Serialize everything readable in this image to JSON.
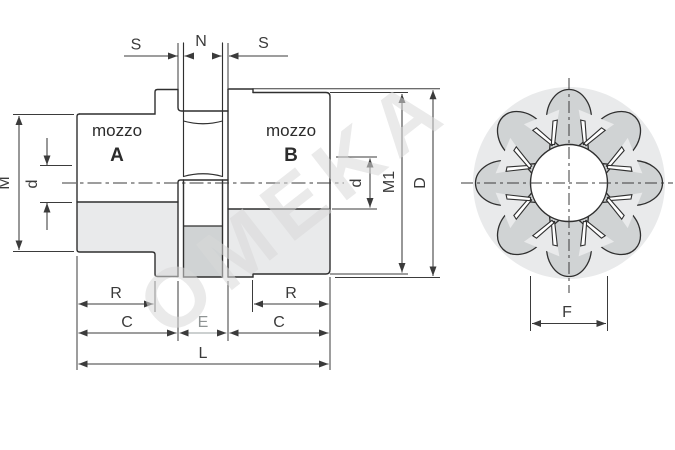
{
  "watermark": "OMEKA",
  "colors": {
    "background": "#ffffff",
    "line": "#2f2f2f",
    "dimension": "#3b3b3b",
    "fill_light": "#e9eaeb",
    "fill_dark": "#d0d3d4",
    "watermark": "#d9d9d9"
  },
  "section_view": {
    "hub_a_label": "mozzo",
    "hub_a_id": "A",
    "hub_b_label": "mozzo",
    "hub_b_id": "B"
  },
  "dims": {
    "s_left": "S",
    "n_center": "N",
    "s_right": "S",
    "m_hub_a": "M",
    "d_bore_a": "d",
    "d_bore_b": "d",
    "m1_hub_b": "M1",
    "d_outer": "D",
    "r_left": "R",
    "c_left": "C",
    "e_center": "E",
    "c_right": "C",
    "r_right": "R",
    "l_total": "L",
    "f_bore": "F"
  }
}
